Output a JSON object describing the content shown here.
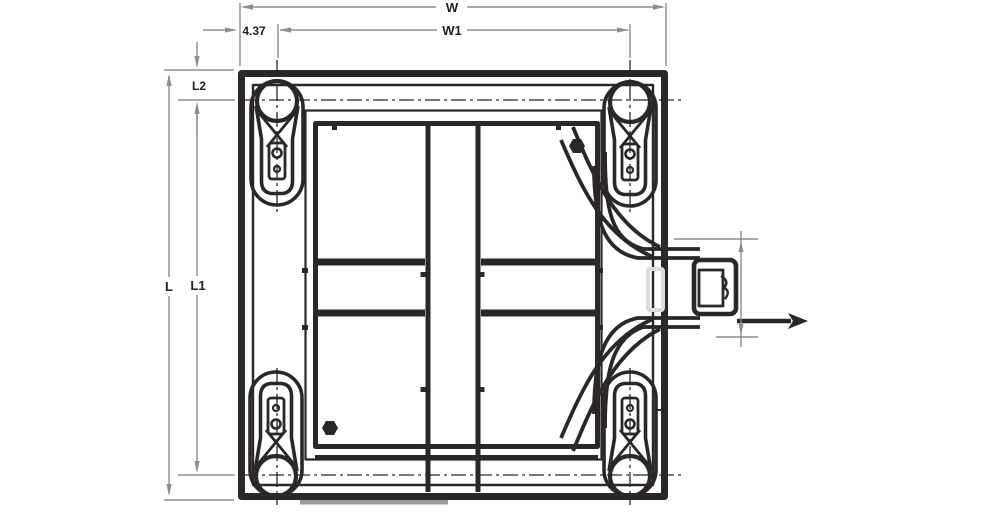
{
  "drawing": {
    "type": "engineering-dimension-drawing-top-view",
    "labels": {
      "width_overall": "W",
      "width_between_casters": "W1",
      "caster_offset_horizontal": "4.37",
      "length_overall": "L",
      "length_between_casters": "L1",
      "caster_offset_vertical": "L2"
    },
    "colors": {
      "line": "#2b2729",
      "dimension_line": "#8d8d8d",
      "label_text": "#231f20",
      "highlight_slot": "#d9dddc",
      "shadow_bar": "#9b9b9b"
    }
  }
}
